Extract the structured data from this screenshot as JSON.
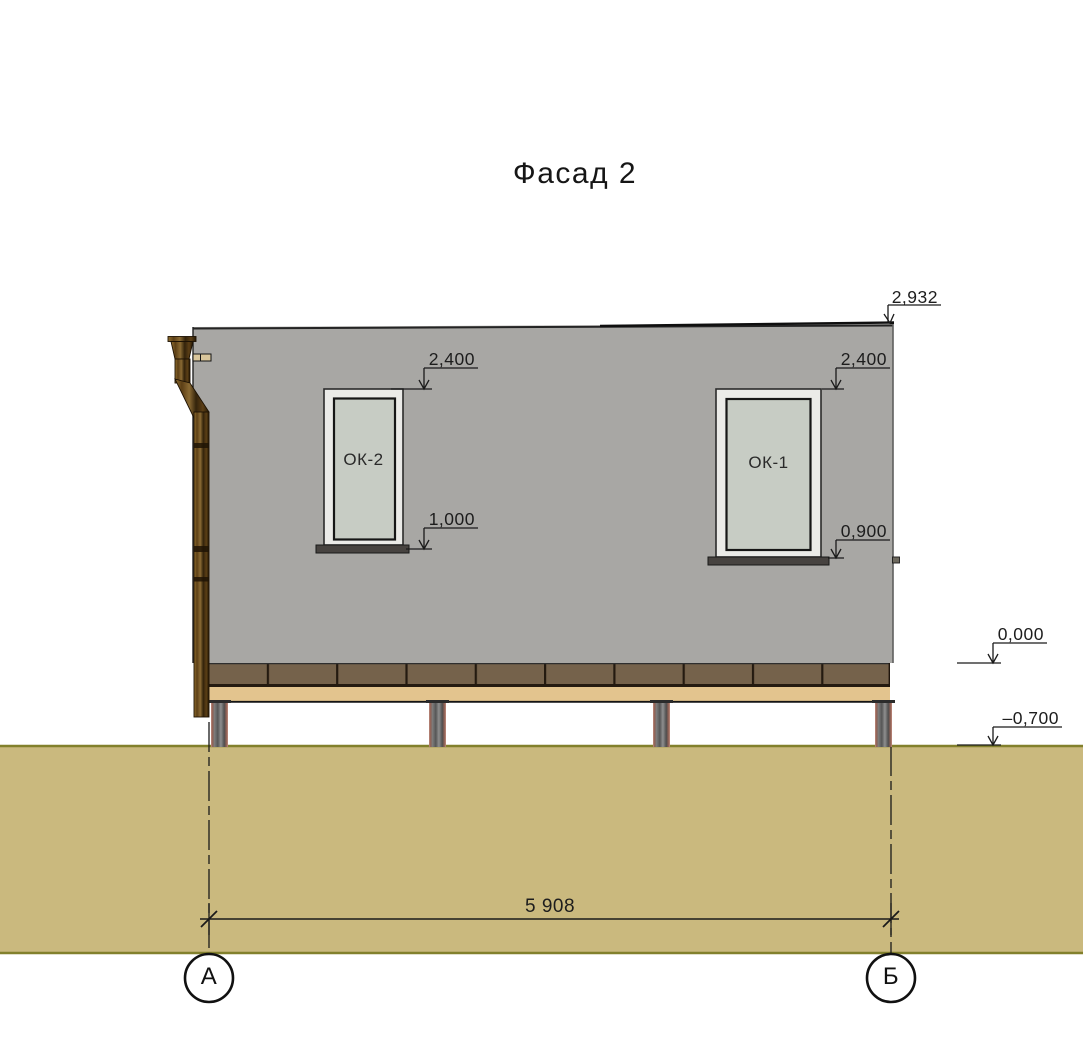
{
  "title": "Фасад 2",
  "windows": [
    {
      "label": "ОК-2",
      "head_mark": "2,400",
      "sill_mark": "1,000"
    },
    {
      "label": "ОК-1",
      "head_mark": "2,400",
      "sill_mark": "0,900"
    }
  ],
  "elevation_marks": {
    "roof": "2,932",
    "floor_level": "0,000",
    "ground_level": "–0,700"
  },
  "dimensions": {
    "overall_width": "5 908"
  },
  "axes": [
    {
      "label": "А"
    },
    {
      "label": "Б"
    }
  ],
  "colors": {
    "wall": "#a8a7a4",
    "window_frame": "#ebebe8",
    "window_glass": "#c7ccc4",
    "sill": "#474340",
    "plinth_brown": "#75624b",
    "plinth_dark": "#241a10",
    "beam_beige": "#e3c48e",
    "ground": "#cab97e",
    "ground_edge": "#82802c",
    "line": "#1a1a1a",
    "tie_plate": "#d9c69b"
  }
}
